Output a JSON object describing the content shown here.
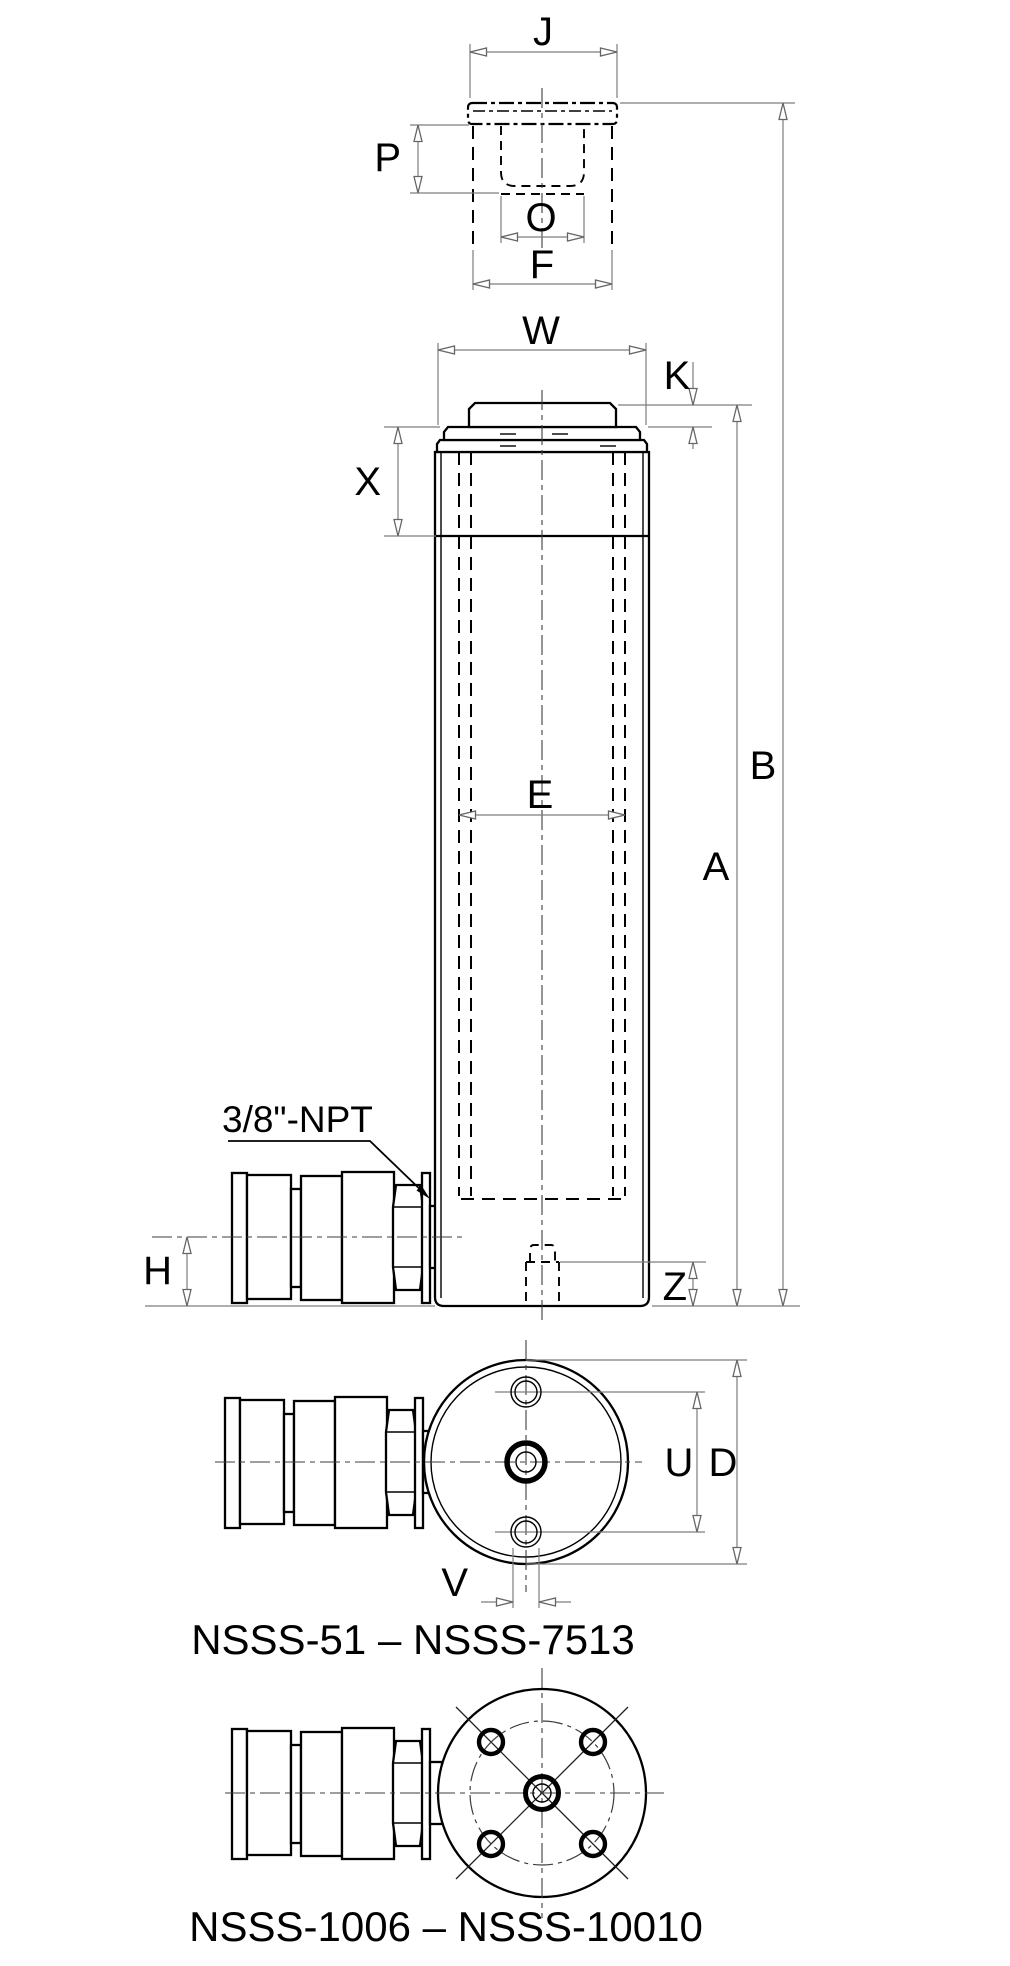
{
  "drawing": {
    "dims": {
      "J": "J",
      "P": "P",
      "O": "O",
      "F": "F",
      "W": "W",
      "K": "K",
      "X": "X",
      "E": "E",
      "A": "A",
      "B": "B",
      "H": "H",
      "Z": "Z",
      "U": "U",
      "D": "D",
      "V": "V"
    },
    "port_label": "3/8\"-NPT",
    "captions": {
      "view1": "NSSS-51 – NSSS-7513",
      "view2": "NSSS-1006 – NSSS-10010"
    },
    "colors": {
      "object_line": "#000000",
      "dimension_line": "#7d7d7d",
      "background": "#ffffff"
    }
  }
}
